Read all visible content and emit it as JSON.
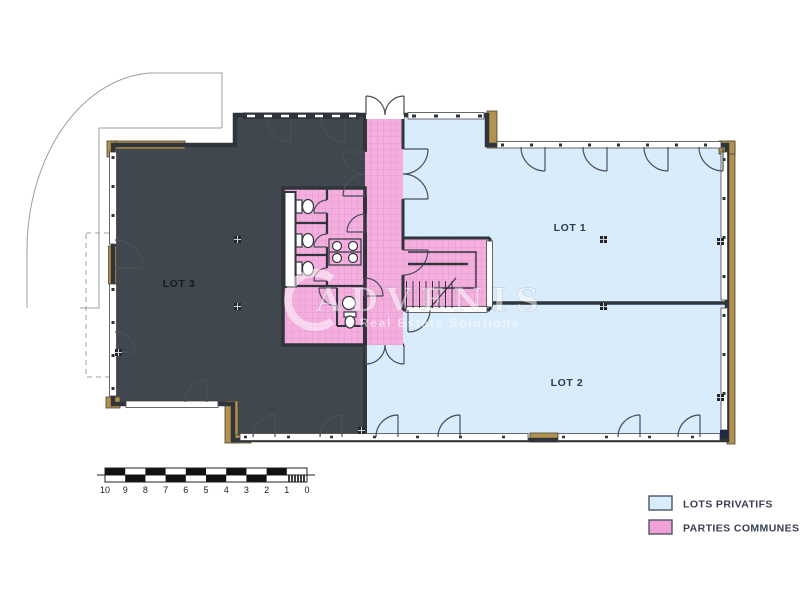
{
  "lots": {
    "lot1": {
      "label": "LOT 1"
    },
    "lot2": {
      "label": "LOT 2"
    },
    "lot3": {
      "label": "LOT 3"
    }
  },
  "legend": {
    "items": [
      {
        "label": "LOTS PRIVATIFS"
      },
      {
        "label": "PARTIES COMMUNES"
      }
    ]
  },
  "scale_bar": {
    "unit_labels": [
      "10",
      "9",
      "8",
      "7",
      "6",
      "5",
      "4",
      "3",
      "2",
      "1",
      "0"
    ]
  },
  "watermark": {
    "brand": "ADVENIS",
    "tagline": "Real Estate Solutions"
  },
  "colors": {
    "lots_privatifs": "#d9ecfb",
    "parties_communes": "#f2a0d8",
    "lot3_dark": "#40474f",
    "wall_tan": "#b3914e"
  }
}
